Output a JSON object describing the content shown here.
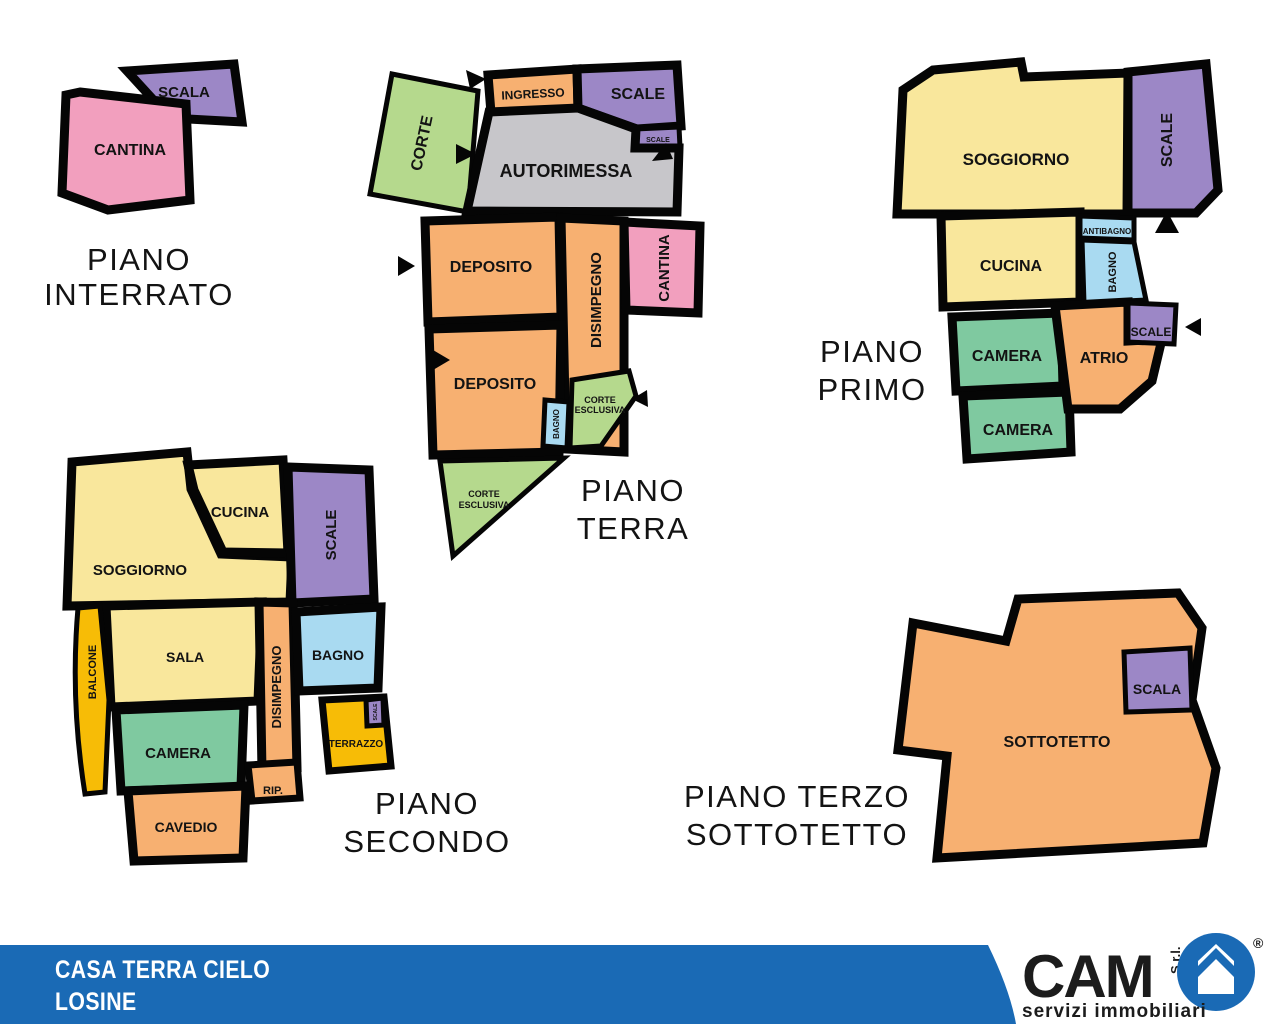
{
  "palette": {
    "pink": "#F29FBE",
    "purple": "#9C87C6",
    "green_light": "#B5D98D",
    "orange": "#F7B071",
    "gray": "#C7C6CA",
    "yellow": "#F9E79C",
    "green": "#7FC9A0",
    "blue_light": "#A9DAF1",
    "gold": "#F7BC06",
    "wall": "#050505",
    "footer_blue": "#1A6AB5"
  },
  "floors": {
    "interrato": {
      "title1": "PIANO",
      "title2": "INTERRATO",
      "scala": "SCALA",
      "cantina": "CANTINA"
    },
    "terra": {
      "title1": "PIANO",
      "title2": "TERRA",
      "corte": "CORTE",
      "ingresso": "INGRESSO",
      "scale": "SCALE",
      "scale_small": "SCALE",
      "autorimessa": "AUTORIMESSA",
      "deposito_1": "DEPOSITO",
      "disimpegno": "DISIMPEGNO",
      "cantina": "CANTINA",
      "deposito_2": "DEPOSITO",
      "bagno": "BAGNO",
      "corte_esclusiva_1a": "CORTE",
      "corte_esclusiva_1b": "ESCLUSIVA",
      "corte_esclusiva_2a": "CORTE",
      "corte_esclusiva_2b": "ESCLUSIVA"
    },
    "primo": {
      "title1": "PIANO",
      "title2": "PRIMO",
      "soggiorno": "SOGGIORNO",
      "scale": "SCALE",
      "cucina": "CUCINA",
      "antibagno": "ANTIBAGNO",
      "bagno": "BAGNO",
      "camera_1": "CAMERA",
      "camera_2": "CAMERA",
      "atrio": "ATRIO",
      "scale_small": "SCALE"
    },
    "secondo": {
      "title1": "PIANO",
      "title2": "SECONDO",
      "cucina": "CUCINA",
      "scale": "SCALE",
      "soggiorno": "SOGGIORNO",
      "balcone": "BALCONE",
      "sala": "SALA",
      "disimpegno": "DISIMPEGNO",
      "bagno": "BAGNO",
      "camera": "CAMERA",
      "terrazzo": "TERRAZZO",
      "scale_small": "SCALE",
      "rip": "RIP.",
      "cavedio": "CAVEDIO"
    },
    "terzo": {
      "title1": "PIANO TERZO",
      "title2": "SOTTOTETTO",
      "sottotetto": "SOTTOTETTO",
      "scala": "SCALA"
    }
  },
  "footer": {
    "property_name": "CASA TERRA CIELO",
    "location": "LOSINE",
    "logo_name": "CAM",
    "logo_suffix": "S.r.l.",
    "logo_tagline": "servizi immobiliari",
    "registered_mark": "®"
  }
}
